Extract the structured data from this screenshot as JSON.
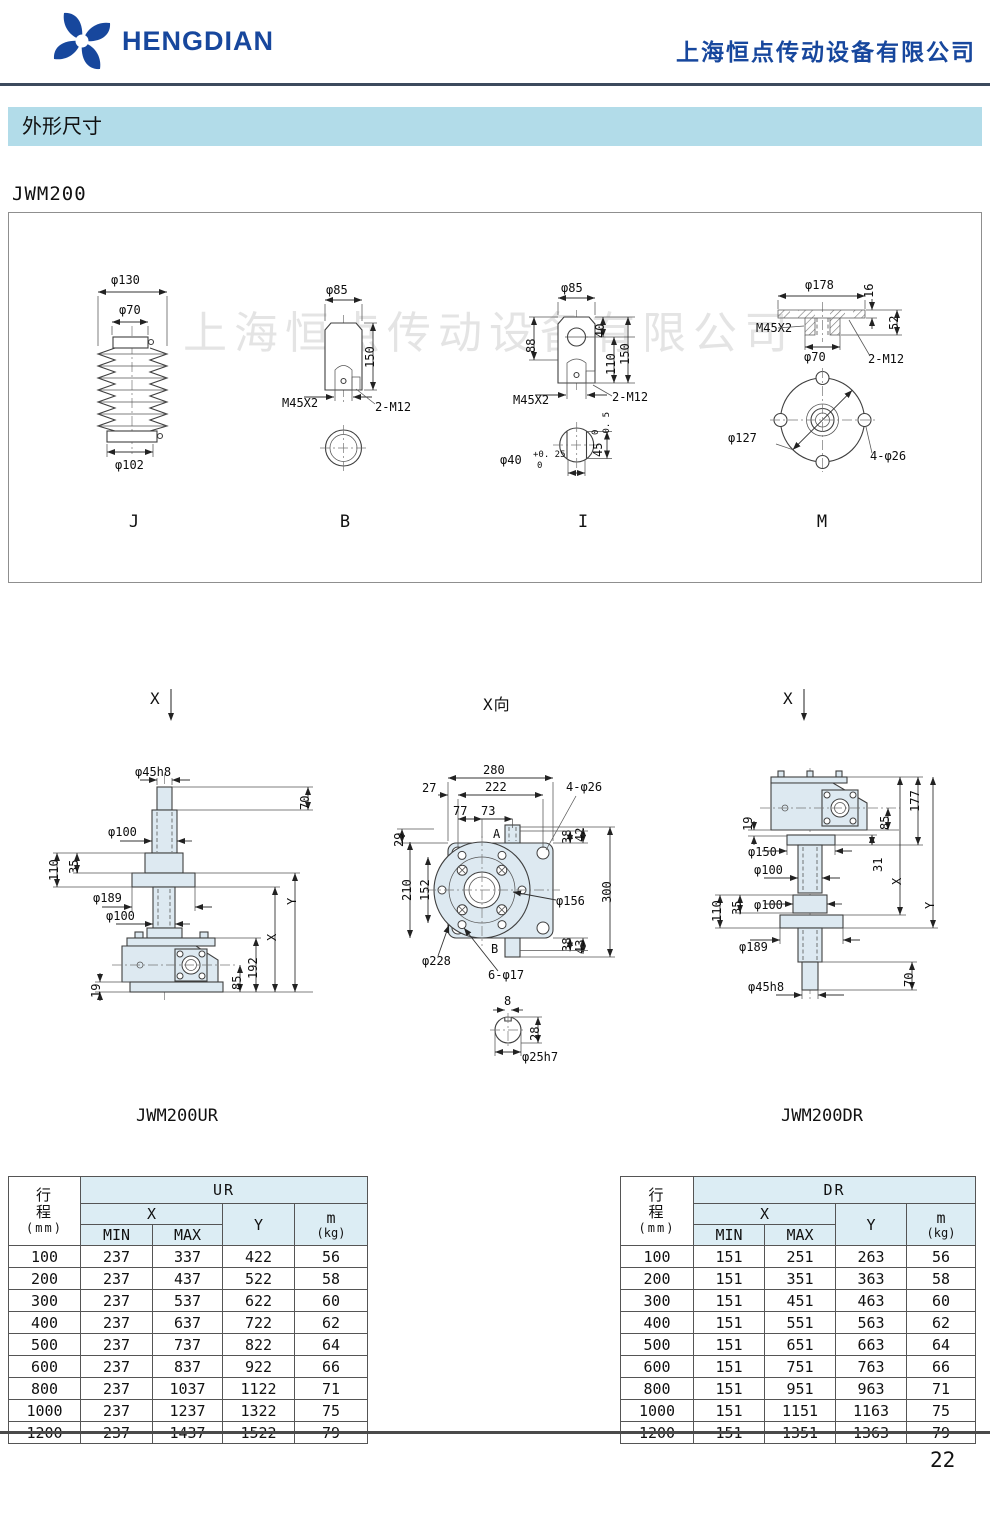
{
  "header": {
    "logo_text": "HENGDIAN",
    "company_name": "上海恒点传动设备有限公司"
  },
  "section_title": "外形尺寸",
  "model_label": "JWM200",
  "watermark": "上海恒点传动设备有限公司",
  "page_number": "22",
  "colors": {
    "brand_blue": "#17479d",
    "banner_blue": "#b2dce9",
    "table_header_blue": "#dcedf4",
    "drawing_fill": "#dde9f1"
  },
  "view_markers": {
    "left": "X",
    "center": "X向",
    "right": "X"
  },
  "drawings": {
    "j": {
      "label": "J",
      "d_top": "φ130",
      "d_mid": "φ70",
      "d_bottom": "φ102"
    },
    "b": {
      "label": "B",
      "d_top": "φ85",
      "d_height": "150",
      "d_thread": "M45X2",
      "d_holes": "2-M12"
    },
    "i": {
      "label": "I",
      "d_top": "φ85",
      "d_left": "88",
      "d_r1": "40",
      "d_r2": "110",
      "d_r3": "150",
      "d_thread": "M45X2",
      "d_holes": "2-M12",
      "d_bore": "φ40",
      "d_bore_tol_top": "+0. 25",
      "d_bore_tol_bot": "0",
      "d_flat": "45",
      "d_flat_tol_top": "0",
      "d_flat_tol_bot": "-0. 5"
    },
    "m": {
      "label": "M",
      "d_top": "φ178",
      "d_t1": "16",
      "d_t2": "52",
      "d_thread": "M45X2",
      "d_bore": "φ70",
      "d_holes": "2-M12",
      "d_bc": "φ127",
      "d_bolt": "4-φ26"
    },
    "ur": {
      "label": "JWM200UR",
      "d_shaft": "φ45h8",
      "d_70": "70",
      "d_100a": "φ100",
      "d_110": "110",
      "d_35": "35",
      "d_189": "φ189",
      "d_100b": "φ100",
      "d_x": "X",
      "d_y": "Y",
      "d_192": "192",
      "d_85": "85",
      "d_19": "19"
    },
    "xview": {
      "d_280": "280",
      "d_222": "222",
      "d_27": "27",
      "d_77": "77",
      "d_73": "73",
      "d_29": "29",
      "d_a": "A",
      "d_b": "B",
      "d_holes4": "4-φ26",
      "d_38t": "38",
      "d_42": "42",
      "d_210": "210",
      "d_152": "152",
      "d_300": "300",
      "d_156": "φ156",
      "d_228": "φ228",
      "d_38b": "38",
      "d_43": "43",
      "d_holes6": "6-φ17",
      "d_8": "8",
      "d_28": "28",
      "d_25": "φ25h7"
    },
    "dr": {
      "label": "JWM200DR",
      "d_19": "19",
      "d_177": "177",
      "d_85": "85",
      "d_150": "φ150",
      "d_31": "31",
      "d_100a": "φ100",
      "d_x": "X",
      "d_y": "Y",
      "d_110": "110",
      "d_35": "35",
      "d_100b": "φ100",
      "d_189": "φ189",
      "d_70": "70",
      "d_shaft": "φ45h8"
    }
  },
  "tables": {
    "left": {
      "stroke_header": "行程",
      "stroke_unit": "(mm)",
      "group": "UR",
      "x_label": "X",
      "min_label": "MIN",
      "max_label": "MAX",
      "y_label": "Y",
      "m_label": "m",
      "m_unit": "(kg)",
      "rows": [
        [
          "100",
          "237",
          "337",
          "422",
          "56"
        ],
        [
          "200",
          "237",
          "437",
          "522",
          "58"
        ],
        [
          "300",
          "237",
          "537",
          "622",
          "60"
        ],
        [
          "400",
          "237",
          "637",
          "722",
          "62"
        ],
        [
          "500",
          "237",
          "737",
          "822",
          "64"
        ],
        [
          "600",
          "237",
          "837",
          "922",
          "66"
        ],
        [
          "800",
          "237",
          "1037",
          "1122",
          "71"
        ],
        [
          "1000",
          "237",
          "1237",
          "1322",
          "75"
        ],
        [
          "1200",
          "237",
          "1437",
          "1522",
          "79"
        ]
      ]
    },
    "right": {
      "stroke_header": "行程",
      "stroke_unit": "(mm)",
      "group": "DR",
      "x_label": "X",
      "min_label": "MIN",
      "max_label": "MAX",
      "y_label": "Y",
      "m_label": "m",
      "m_unit": "(kg)",
      "rows": [
        [
          "100",
          "151",
          "251",
          "263",
          "56"
        ],
        [
          "200",
          "151",
          "351",
          "363",
          "58"
        ],
        [
          "300",
          "151",
          "451",
          "463",
          "60"
        ],
        [
          "400",
          "151",
          "551",
          "563",
          "62"
        ],
        [
          "500",
          "151",
          "651",
          "663",
          "64"
        ],
        [
          "600",
          "151",
          "751",
          "763",
          "66"
        ],
        [
          "800",
          "151",
          "951",
          "963",
          "71"
        ],
        [
          "1000",
          "151",
          "1151",
          "1163",
          "75"
        ],
        [
          "1200",
          "151",
          "1351",
          "1363",
          "79"
        ]
      ]
    }
  }
}
